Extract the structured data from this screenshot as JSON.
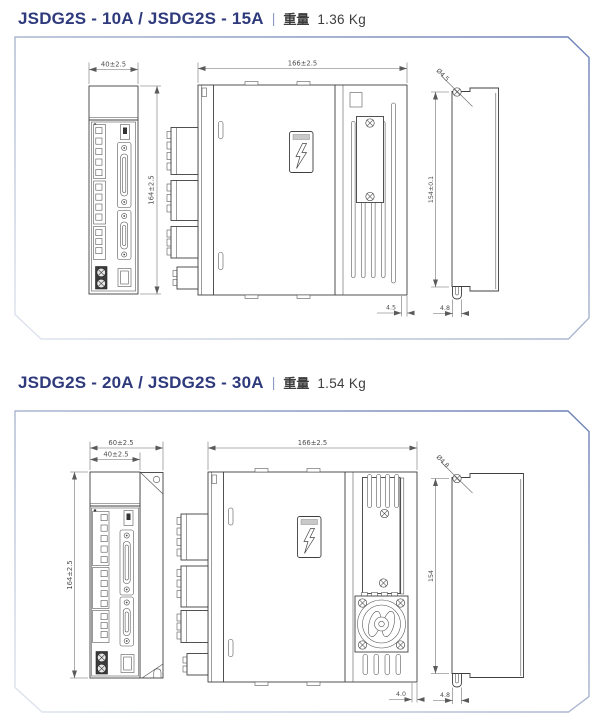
{
  "colors": {
    "title_text": "#2e3a7c",
    "separator": "#8b9cc0",
    "panel_border_light": "#e0e5ee",
    "panel_border_dark": "#6c80b7",
    "drawing_line": "#3f3f3f",
    "dimension_text": "#4f4f4f"
  },
  "sections": [
    {
      "title": {
        "model": "JSDG2S - 10A / JSDG2S - 15A",
        "separator": "|",
        "weight_label": "重量",
        "weight_value": "1.36 Kg"
      },
      "dimensions": {
        "front_width": "40±2.5",
        "front_height": "164±2.5",
        "depth": "166±2.5",
        "heatsink_offset": "4.5",
        "mount_hole_dia": "Ø4.5",
        "mount_hole_pitch": "154±0.1",
        "mount_slot_width": "4.8"
      }
    },
    {
      "title": {
        "model": "JSDG2S - 20A / JSDG2S - 30A",
        "separator": "|",
        "weight_label": "重量",
        "weight_value": "1.54 Kg"
      },
      "dimensions": {
        "overall_width": "60±2.5",
        "front_width": "40±2.5",
        "front_height": "164±2.5",
        "depth": "166±2.5",
        "heatsink_offset": "4.0",
        "mount_hole_dia": "Ø4.8",
        "mount_hole_pitch": "154",
        "mount_slot_width": "4.8"
      }
    }
  ]
}
